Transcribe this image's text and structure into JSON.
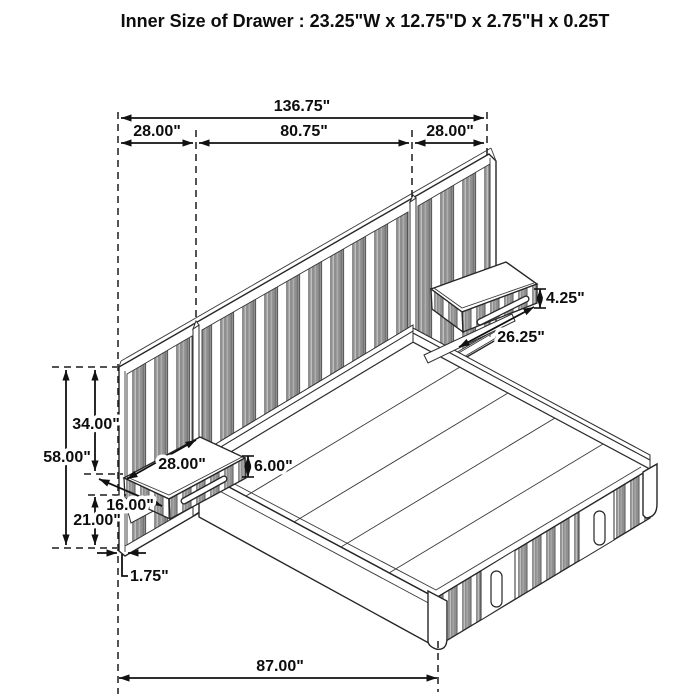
{
  "title": "Inner Size of Drawer : 23.25\"W x 12.75\"D x 2.75\"H x 0.25T",
  "dims": {
    "overall_width": "136.75\"",
    "wing_left_width": "28.00\"",
    "center_width": "80.75\"",
    "wing_right_width": "28.00\"",
    "headboard_height": "58.00\"",
    "upper_height": "34.00\"",
    "lower_height": "21.00\"",
    "nightstand_left_depth": "28.00\"",
    "nightstand_left_front": "16.00\"",
    "nightstand_left_height": "6.00\"",
    "nightstand_right_height": "4.25\"",
    "nightstand_right_width": "26.25\"",
    "floor_offset": "1.75\"",
    "platform_length": "87.00\""
  },
  "colors": {
    "line": "#262626",
    "slat_gray": "#8f8f8f",
    "background": "#ffffff"
  }
}
